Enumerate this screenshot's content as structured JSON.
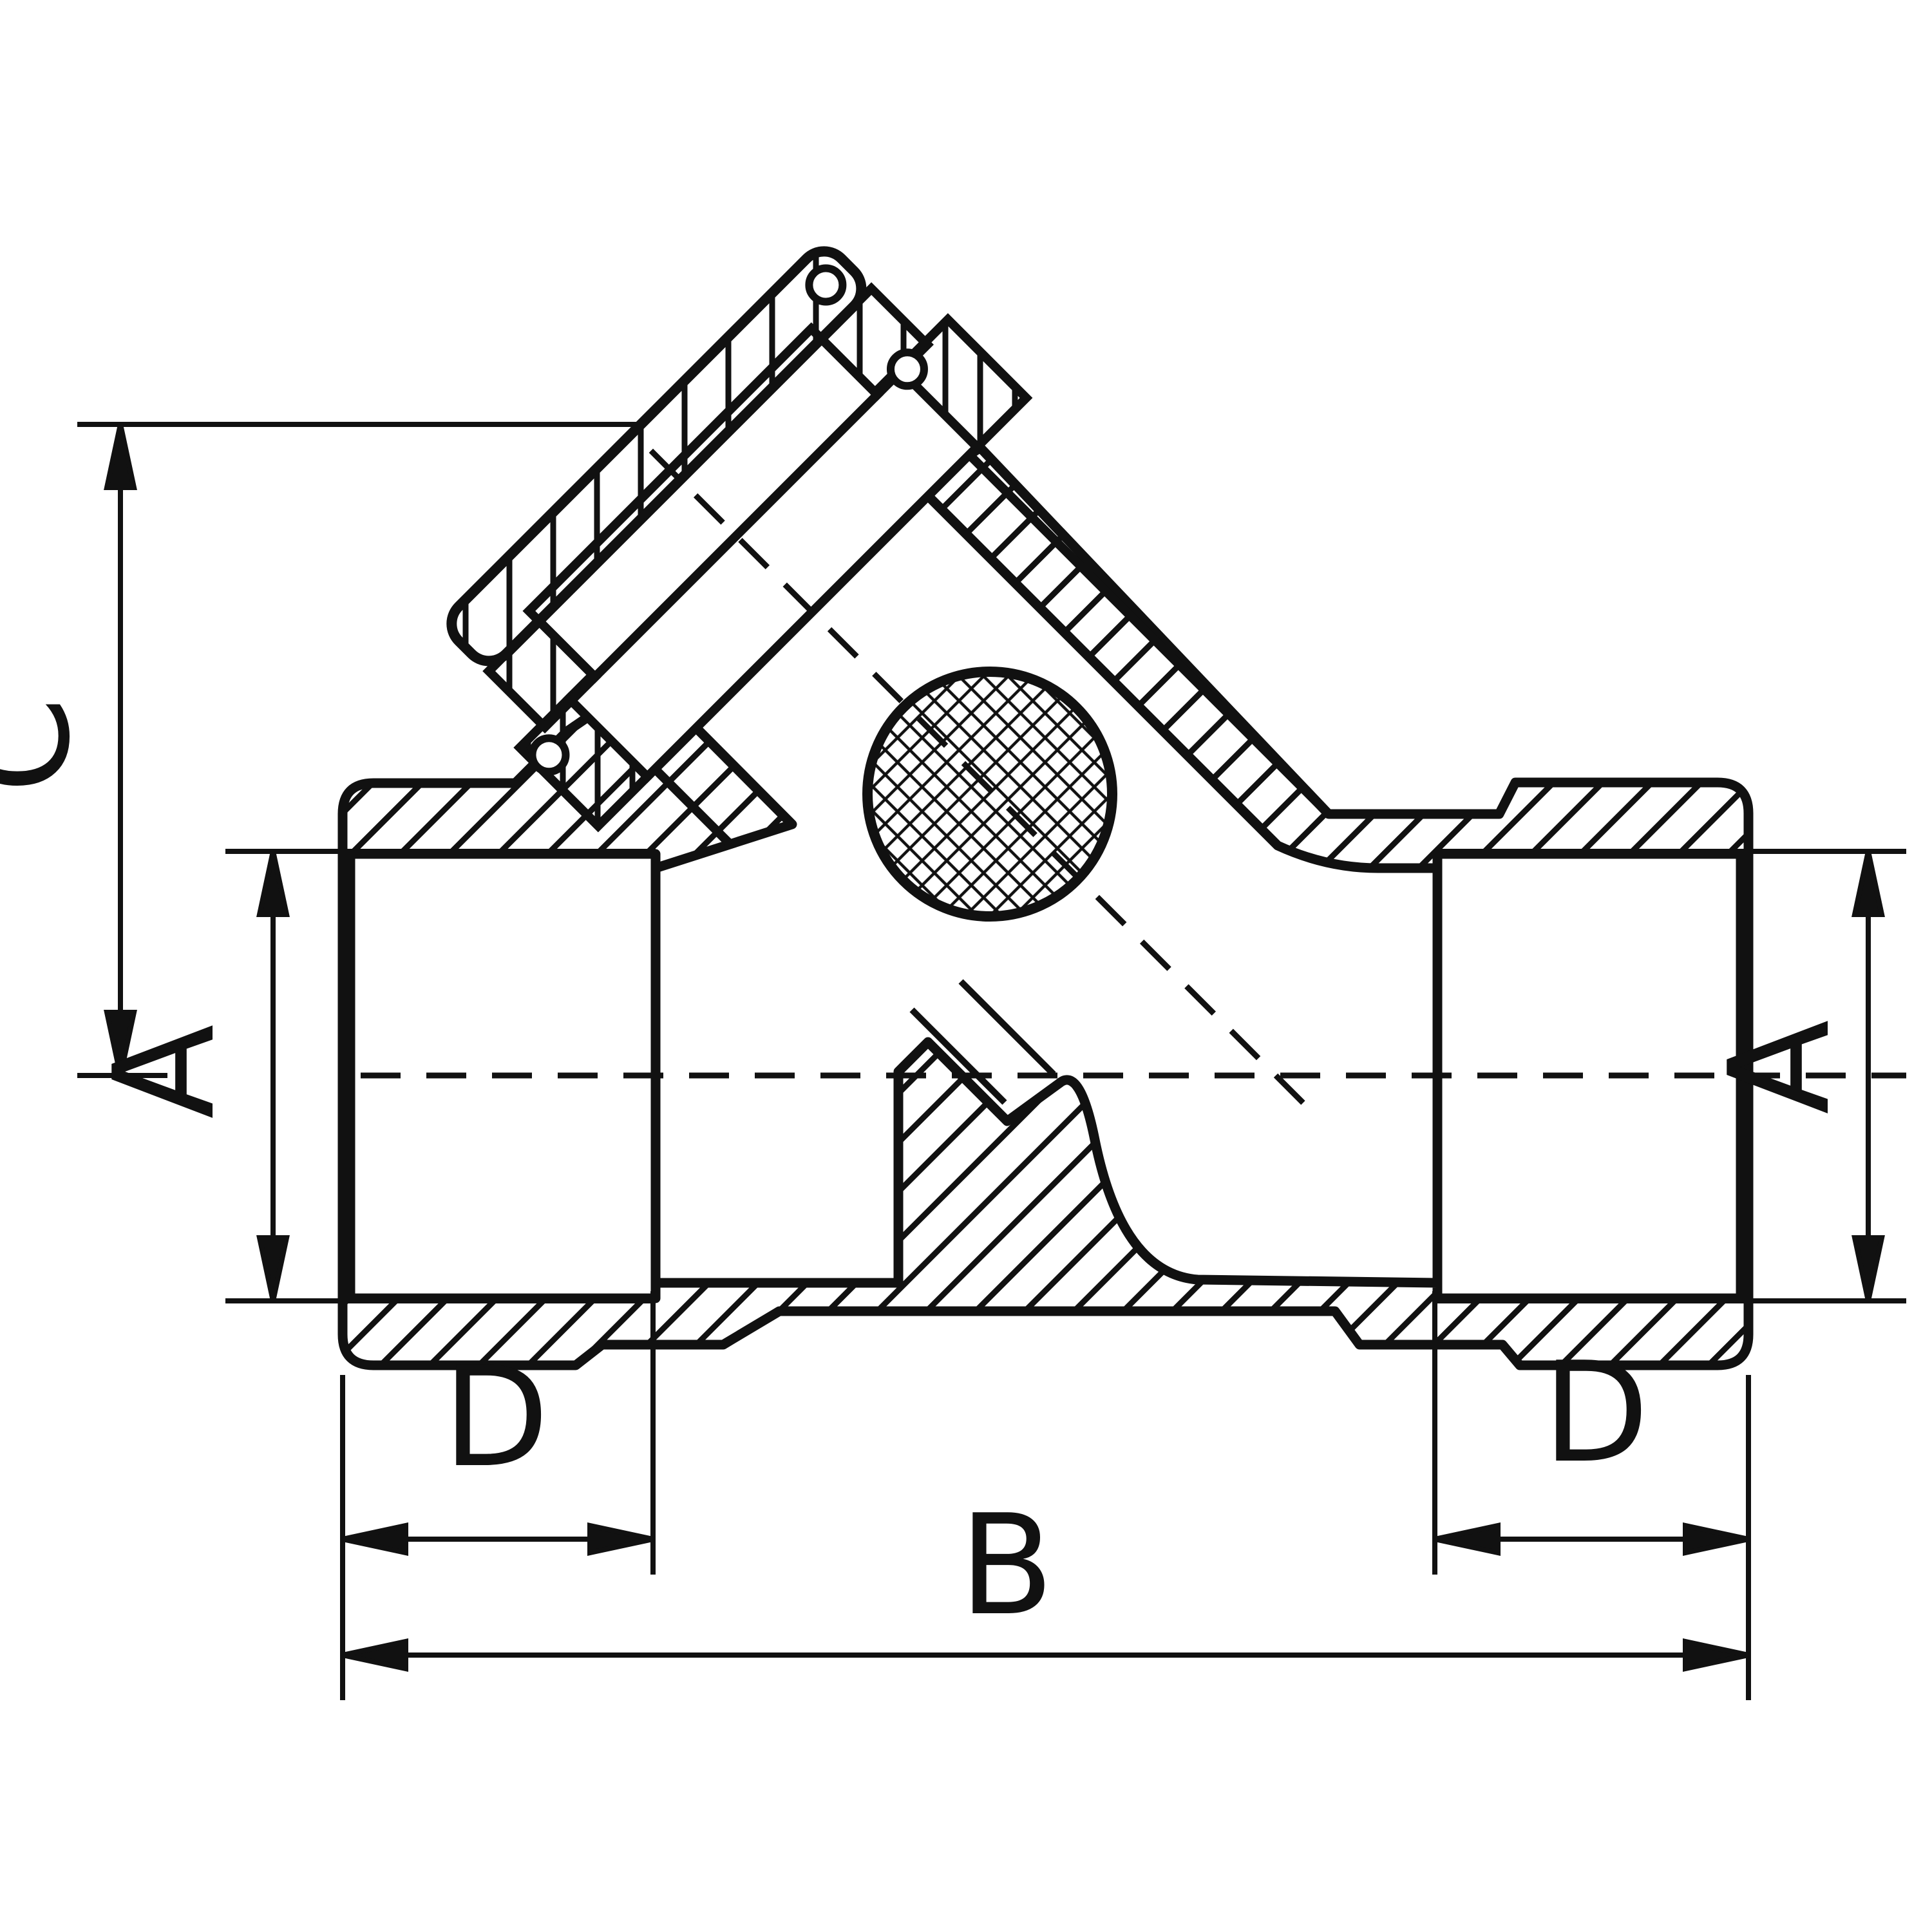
{
  "drawing": {
    "kind": "technical-section-drawing",
    "subject": "Y-strainer pipe fitting cross-section with 45-degree bonnet cap and mesh screen",
    "background": "#ffffff",
    "ink": "#111111"
  },
  "dimensions": {
    "c_label": "C",
    "a_left_label": "A",
    "a_right_label": "A",
    "d_left_label": "D",
    "d_right_label": "D",
    "b_label": "B"
  },
  "features": {
    "screen_icon": "cross-hatched strainer screen circle",
    "hatching": "diagonal section hatching",
    "centerline_style": "dashed",
    "branch_angle_deg": 45
  }
}
